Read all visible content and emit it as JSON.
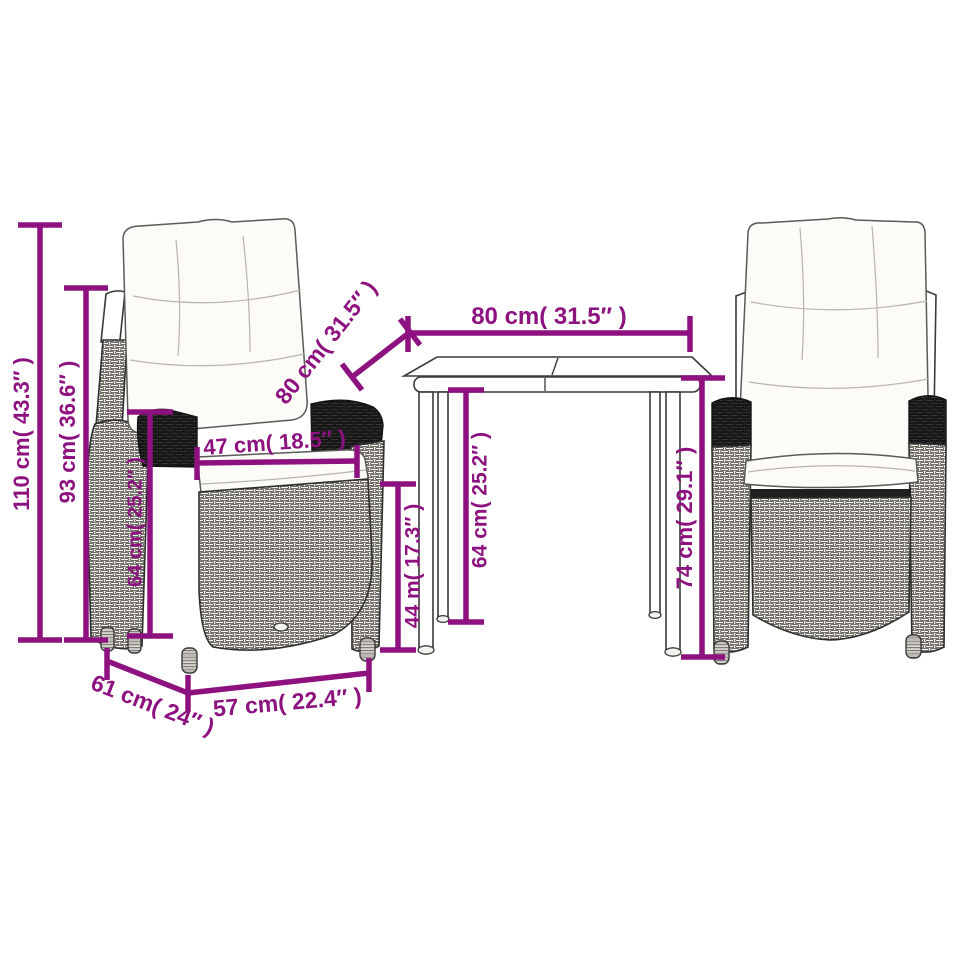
{
  "diagram": {
    "type": "product-dimension-diagram",
    "subject": "bistro set: two wicker reclining chairs with cushions and a square table",
    "background": "#ffffff"
  },
  "colors": {
    "dimension": "#8E1180",
    "line_art": "#3a3a3a",
    "cushion_fill": "#fcfbf7",
    "background": "#ffffff"
  },
  "dimensions": {
    "chair_total_height": "110 cm( 43.3″ )",
    "chair_back_height": "93 cm( 36.6″ )",
    "chair_armrest_height": "64 cm( 25.2″ )",
    "chair_seat_width": "47 cm( 18.5″ )",
    "table_depth": "80 cm( 31.5″ )",
    "table_width": "80 cm( 31.5″ )",
    "table_clearance_height": "64 cm( 25.2″ )",
    "chair_seat_height": "44 m( 17.3″ )",
    "table_height": "74 cm( 29.1″ )",
    "chair_depth": "61 cm( 24″ )",
    "chair_width": "57 cm( 22.4″ )"
  }
}
